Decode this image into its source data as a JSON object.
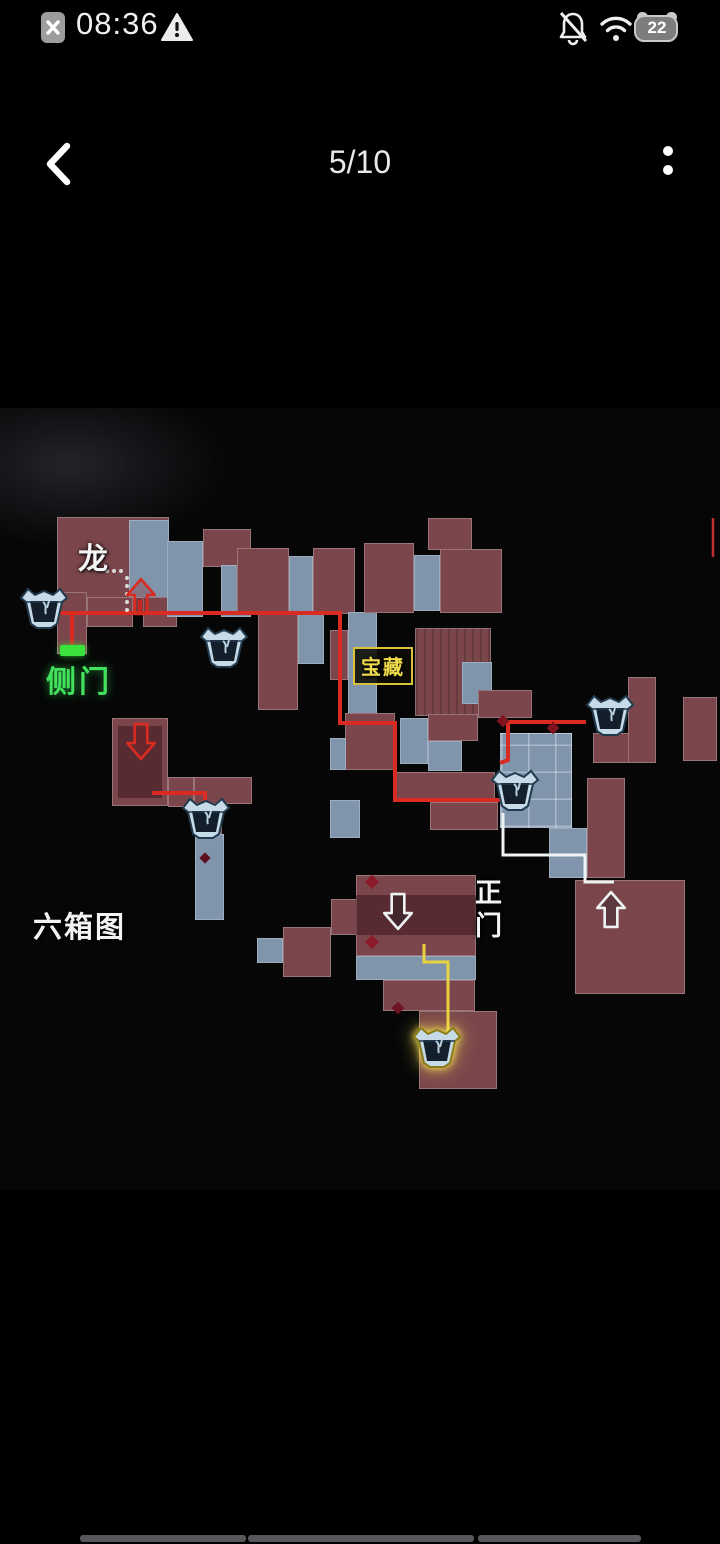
{
  "status_bar": {
    "time": "08:36",
    "battery_level": "22",
    "icons": [
      "sim-missing-icon",
      "warning-triangle-icon",
      "bell-muted-icon",
      "wifi-icon",
      "battery-icon"
    ]
  },
  "header": {
    "title": "5/10",
    "back_icon": "chevron-left",
    "menu_icon": "two-dot-menu"
  },
  "map": {
    "caption": "六箱图",
    "labels": {
      "dragon": "龙",
      "side_door": "侧门",
      "treasure": "宝藏",
      "main_gate": "正门"
    },
    "colors": {
      "room_red": "#7a464b",
      "room_blue": "#8095ab",
      "path_red": "#d92b22",
      "path_yellow": "#e8d23f",
      "path_white": "#eef2f2",
      "door_green": "#3ce23c",
      "treasure_yellow": "#f2dd4e"
    },
    "rooms": [
      [
        57,
        517,
        112,
        96,
        "r"
      ],
      [
        129,
        520,
        40,
        78,
        "b"
      ],
      [
        57,
        592,
        30,
        62,
        "r"
      ],
      [
        87,
        597,
        46,
        30,
        "r"
      ],
      [
        143,
        597,
        34,
        30,
        "r"
      ],
      [
        167,
        541,
        36,
        76,
        "b"
      ],
      [
        203,
        529,
        48,
        38,
        "r"
      ],
      [
        221,
        565,
        30,
        52,
        "b"
      ],
      [
        237,
        548,
        52,
        66,
        "r"
      ],
      [
        289,
        556,
        24,
        58,
        "b"
      ],
      [
        313,
        548,
        42,
        66,
        "r"
      ],
      [
        258,
        614,
        40,
        96,
        "r"
      ],
      [
        298,
        614,
        26,
        50,
        "b"
      ],
      [
        348,
        612,
        29,
        112,
        "b"
      ],
      [
        330,
        630,
        18,
        50,
        "r"
      ],
      [
        364,
        543,
        50,
        70,
        "r"
      ],
      [
        414,
        555,
        26,
        56,
        "b"
      ],
      [
        428,
        518,
        44,
        32,
        "r"
      ],
      [
        440,
        549,
        62,
        64,
        "r"
      ],
      [
        415,
        628,
        76,
        88,
        "r tex"
      ],
      [
        462,
        662,
        30,
        42,
        "b"
      ],
      [
        400,
        718,
        28,
        46,
        "b"
      ],
      [
        345,
        713,
        50,
        57,
        "r"
      ],
      [
        330,
        738,
        16,
        32,
        "b"
      ],
      [
        428,
        714,
        50,
        27,
        "r"
      ],
      [
        428,
        741,
        34,
        30,
        "b"
      ],
      [
        478,
        690,
        54,
        28,
        "r"
      ],
      [
        500,
        733,
        72,
        95,
        "b grid"
      ],
      [
        549,
        828,
        38,
        50,
        "b"
      ],
      [
        587,
        778,
        38,
        100,
        "r"
      ],
      [
        593,
        733,
        60,
        30,
        "r"
      ],
      [
        628,
        677,
        28,
        86,
        "r"
      ],
      [
        683,
        697,
        34,
        64,
        "r"
      ],
      [
        395,
        772,
        100,
        30,
        "r"
      ],
      [
        430,
        802,
        68,
        28,
        "r"
      ],
      [
        330,
        800,
        30,
        38,
        "b"
      ],
      [
        112,
        718,
        56,
        88,
        "r"
      ],
      [
        168,
        777,
        26,
        30,
        "r"
      ],
      [
        194,
        777,
        58,
        27,
        "r"
      ],
      [
        194,
        804,
        28,
        30,
        "r"
      ],
      [
        195,
        834,
        29,
        86,
        "b"
      ],
      [
        257,
        938,
        26,
        25,
        "b"
      ],
      [
        283,
        927,
        48,
        50,
        "r"
      ],
      [
        331,
        899,
        26,
        36,
        "r"
      ],
      [
        356,
        875,
        120,
        81,
        "r"
      ],
      [
        356,
        956,
        120,
        24,
        "b"
      ],
      [
        383,
        980,
        92,
        31,
        "r"
      ],
      [
        419,
        1011,
        78,
        78,
        "r"
      ],
      [
        575,
        880,
        110,
        114,
        "r"
      ],
      [
        118,
        726,
        44,
        72,
        "shade"
      ],
      [
        356,
        895,
        120,
        40,
        "shade"
      ]
    ],
    "paths": {
      "red": [
        "52,613 340,613 340,723 395,723 395,800 528,800",
        "72,613 72,649",
        "140,613 140,600",
        "586,722 508,722 508,760 500,763",
        "152,793 205,793 205,807"
      ],
      "yellow": [
        "424,944 424,962 448,962 448,1036"
      ],
      "white": [
        "503,813 503,855 585,855 585,882 614,882"
      ]
    },
    "dotted_trail": [
      [
        107,
        571
      ],
      [
        114,
        571
      ],
      [
        121,
        571
      ],
      [
        127,
        578
      ],
      [
        127,
        586
      ],
      [
        127,
        594
      ],
      [
        127,
        602
      ],
      [
        127,
        610
      ]
    ],
    "diamonds": [
      {
        "x": 503,
        "y": 721,
        "s": 9,
        "c": "#7e1420"
      },
      {
        "x": 553,
        "y": 728,
        "s": 9,
        "c": "#7e1420"
      },
      {
        "x": 372,
        "y": 882,
        "s": 10,
        "c": "#8c1a28"
      },
      {
        "x": 372,
        "y": 942,
        "s": 10,
        "c": "#8c1a28"
      },
      {
        "x": 398,
        "y": 1008,
        "s": 9,
        "c": "#6e1422"
      },
      {
        "x": 205,
        "y": 858,
        "s": 8,
        "c": "#5c1020"
      }
    ],
    "red_sliver": {
      "x": 713,
      "y1": 518,
      "y2": 557
    },
    "chests": [
      {
        "x": 44,
        "y": 607
      },
      {
        "x": 224,
        "y": 646
      },
      {
        "x": 515,
        "y": 789
      },
      {
        "x": 610,
        "y": 714
      },
      {
        "x": 206,
        "y": 817
      },
      {
        "x": 437,
        "y": 1046,
        "glow": true
      }
    ],
    "arrows": [
      {
        "x": 126,
        "y": 577,
        "dir": "up",
        "c": "red"
      },
      {
        "x": 126,
        "y": 722,
        "dir": "down",
        "c": "red"
      },
      {
        "x": 383,
        "y": 892,
        "dir": "down",
        "c": "white"
      },
      {
        "x": 596,
        "y": 890,
        "dir": "up",
        "c": "white"
      }
    ]
  },
  "footer": {
    "bars": [
      {
        "x": 80,
        "w": 166
      },
      {
        "x": 248,
        "w": 226
      },
      {
        "x": 478,
        "w": 163
      }
    ]
  }
}
